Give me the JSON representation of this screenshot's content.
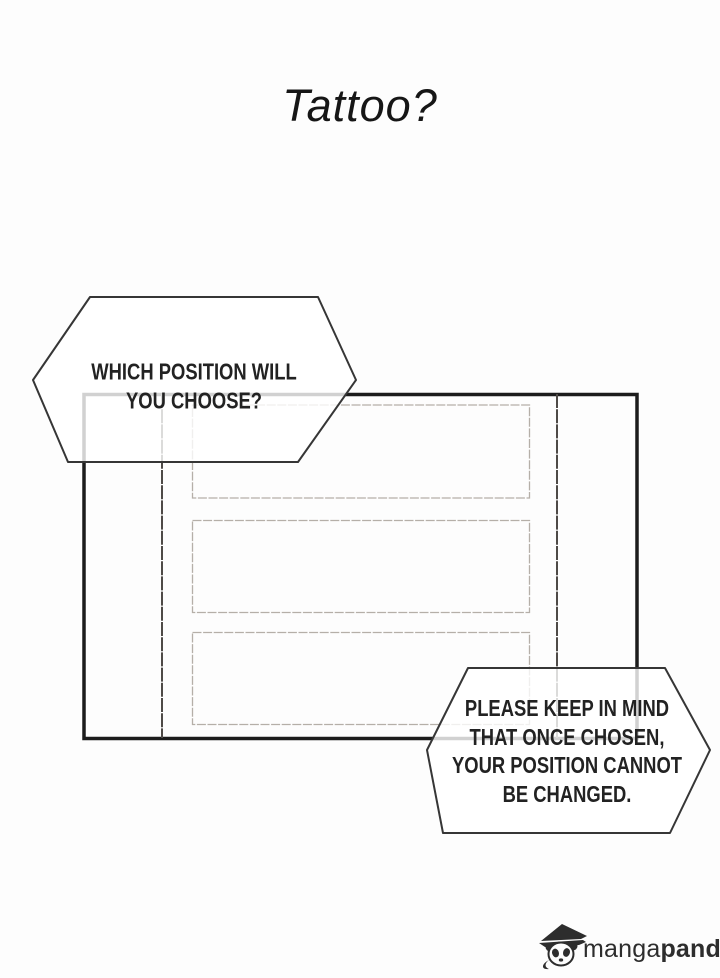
{
  "page": {
    "background": "#fdfdfd"
  },
  "title": "Tattoo?",
  "speech": {
    "question": {
      "lines": [
        "WHICH POSITION WILL",
        "YOU CHOOSE?"
      ]
    },
    "warning": {
      "lines": [
        "PLEASE KEEP IN MIND",
        "THAT ONCE CHOSEN,",
        "YOUR POSITION CANNOT",
        "BE CHANGED."
      ]
    }
  },
  "colors": {
    "ink": "#161616",
    "panel_border": "#1c1c1c",
    "divider_line": "#4e4a47",
    "slot_border": "#b5afa8",
    "bubble_border": "#363636",
    "bubble_fill": "rgba(255,255,255,0.8)",
    "text": "#222222",
    "logo": "#2d2d2d"
  },
  "watermark": {
    "brand_light": "manga",
    "brand_bold": "panda"
  }
}
